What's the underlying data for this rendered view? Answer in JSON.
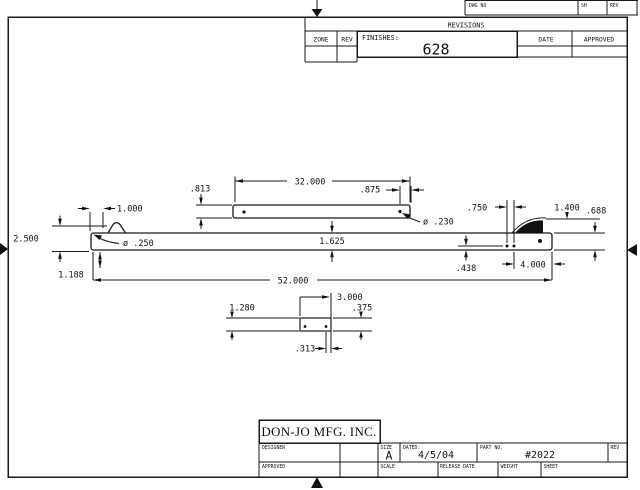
{
  "sheet": {
    "top_strip": {
      "dwg_no": "DWG NO",
      "sh": "SH",
      "rev": "REV"
    },
    "revisions": {
      "title": "REVISIONS",
      "zone": "ZONE",
      "rev": "REV",
      "finishes_label": "FINISHES:",
      "finishes_value": "628",
      "date": "DATE",
      "approved": "APPROVED"
    },
    "title_block": {
      "company": "DON-JO MFG. INC.",
      "designer_label": "DESIGNER",
      "approved_label": "APPROVED",
      "size_label": "SIZE",
      "size_value": "A",
      "date_label": "DATED:",
      "date_value": "4/5/04",
      "part_no_label": "PART NO.",
      "part_no_value": "#2022",
      "rev_label": "REV",
      "scale_label": "SCALE",
      "release_date_label": "RELEASE DATE",
      "weight_label": "WEIGHT",
      "sheet_label": "SHEET"
    },
    "dimensions": {
      "rod_length": "32.000",
      "rod_height": ".813",
      "rod_hole_offset": ".875",
      "rod_hole_dia": "ø .230",
      "bar_length": "52.000",
      "bar_height": "1.625",
      "bar_hole_dia": "ø .250",
      "clip_offset": "1.000",
      "overall_height": "2.500",
      "left_offset": "1.188",
      "hole_spacing": ".750",
      "end_offset": "4.000",
      "hole_height": ".438",
      "latch_offset": "1.400",
      "end_height": ".688",
      "plate_length": "3.000",
      "plate_offset": "1.280",
      "plate_height": ".375",
      "plate_hole_offset": ".313"
    }
  }
}
